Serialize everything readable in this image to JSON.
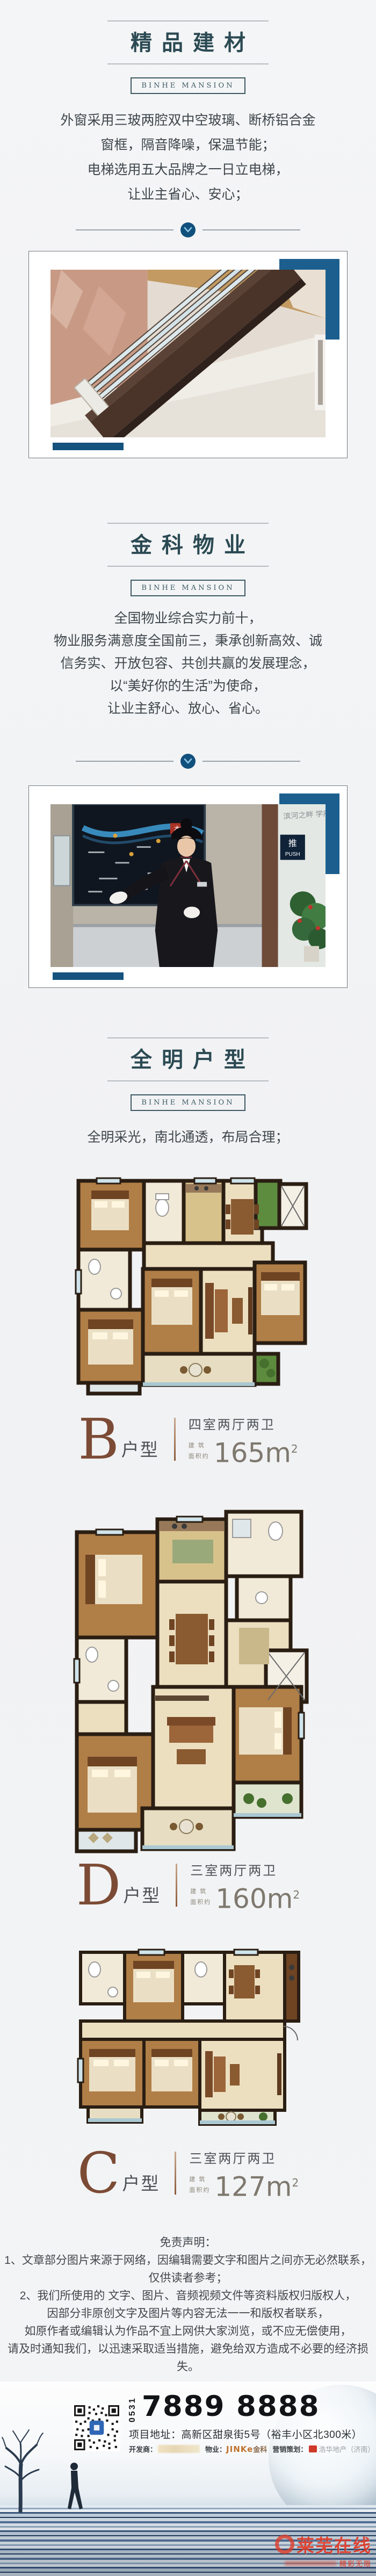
{
  "section_materials": {
    "title": "精品建材",
    "badge": "BINHE MANSION",
    "lines": [
      "外窗采用三玻两腔双中空玻璃、断桥铝合金",
      "窗框，隔音降噪，保温节能；",
      "电梯选用五大品牌之一日立电梯，",
      "让业主省心、安心；"
    ]
  },
  "section_property": {
    "title": "金科物业",
    "badge": "BINHE MANSION",
    "lines": [
      "全国物业综合实力前十，",
      "物业服务满意度全国前三，秉承创新高效、诚",
      "信务实、开放包容、共创共赢的发展理念，",
      "以“美好你的生活”为使命，",
      "让业主舒心、放心、省心。"
    ]
  },
  "section_floorplan": {
    "title": "全明户型",
    "badge": "BINHE MANSION",
    "lines": [
      "全明采光，南北通透，布局合理；"
    ]
  },
  "photo_concierge": {
    "glass_text": "滨河之畔 学府",
    "push_sign_cn": "推",
    "push_sign_en": "PUSH",
    "map_tag": "本案"
  },
  "plans": [
    {
      "letter": "B",
      "suffix": "户型",
      "rooms": "四室两厅两卫",
      "area_label_top": "建 筑",
      "area_label_bottom": "面积约",
      "area": "165m",
      "area_sup": "2"
    },
    {
      "letter": "D",
      "suffix": "户型",
      "rooms": "三室两厅两卫",
      "area_label_top": "建 筑",
      "area_label_bottom": "面积约",
      "area": "160m",
      "area_sup": "2"
    },
    {
      "letter": "C",
      "suffix": "户型",
      "rooms": "三室两厅两卫",
      "area_label_top": "建 筑",
      "area_label_bottom": "面积约",
      "area": "127m",
      "area_sup": "2"
    }
  ],
  "disclaimer": {
    "title": "免责声明：",
    "lines": [
      "1、文章部分图片来源于网络，因编辑需要文字和图片之间亦无必然联系，",
      "仅供读者参考；",
      "2、我们所使用的 文字、图片、音频视频文件等资料版权归版权人，",
      "因部分非原创文字及图片等内容无法一一和版权者联系，",
      "如原作者或编辑认为作品不宜上网供大家浏览，或不应无偿使用，",
      "请及时通知我们，以迅速采取适当措施，避免给双方造成不必要的经济损失。"
    ]
  },
  "footer": {
    "area_code": "0531",
    "phone": "7889 8888",
    "address": "项目地址：高新区甜泉街5号（裕丰小区北300米）",
    "developer_label": "开发商：",
    "pm_label": "物业：",
    "pm_name": "JINKe",
    "pm_name_cn": "金科",
    "marketing_label": "营销策划：",
    "marketing_name": "浩华地产（济南）",
    "watermark": "莱芜在线",
    "watermark_sub": "精彩无限"
  }
}
